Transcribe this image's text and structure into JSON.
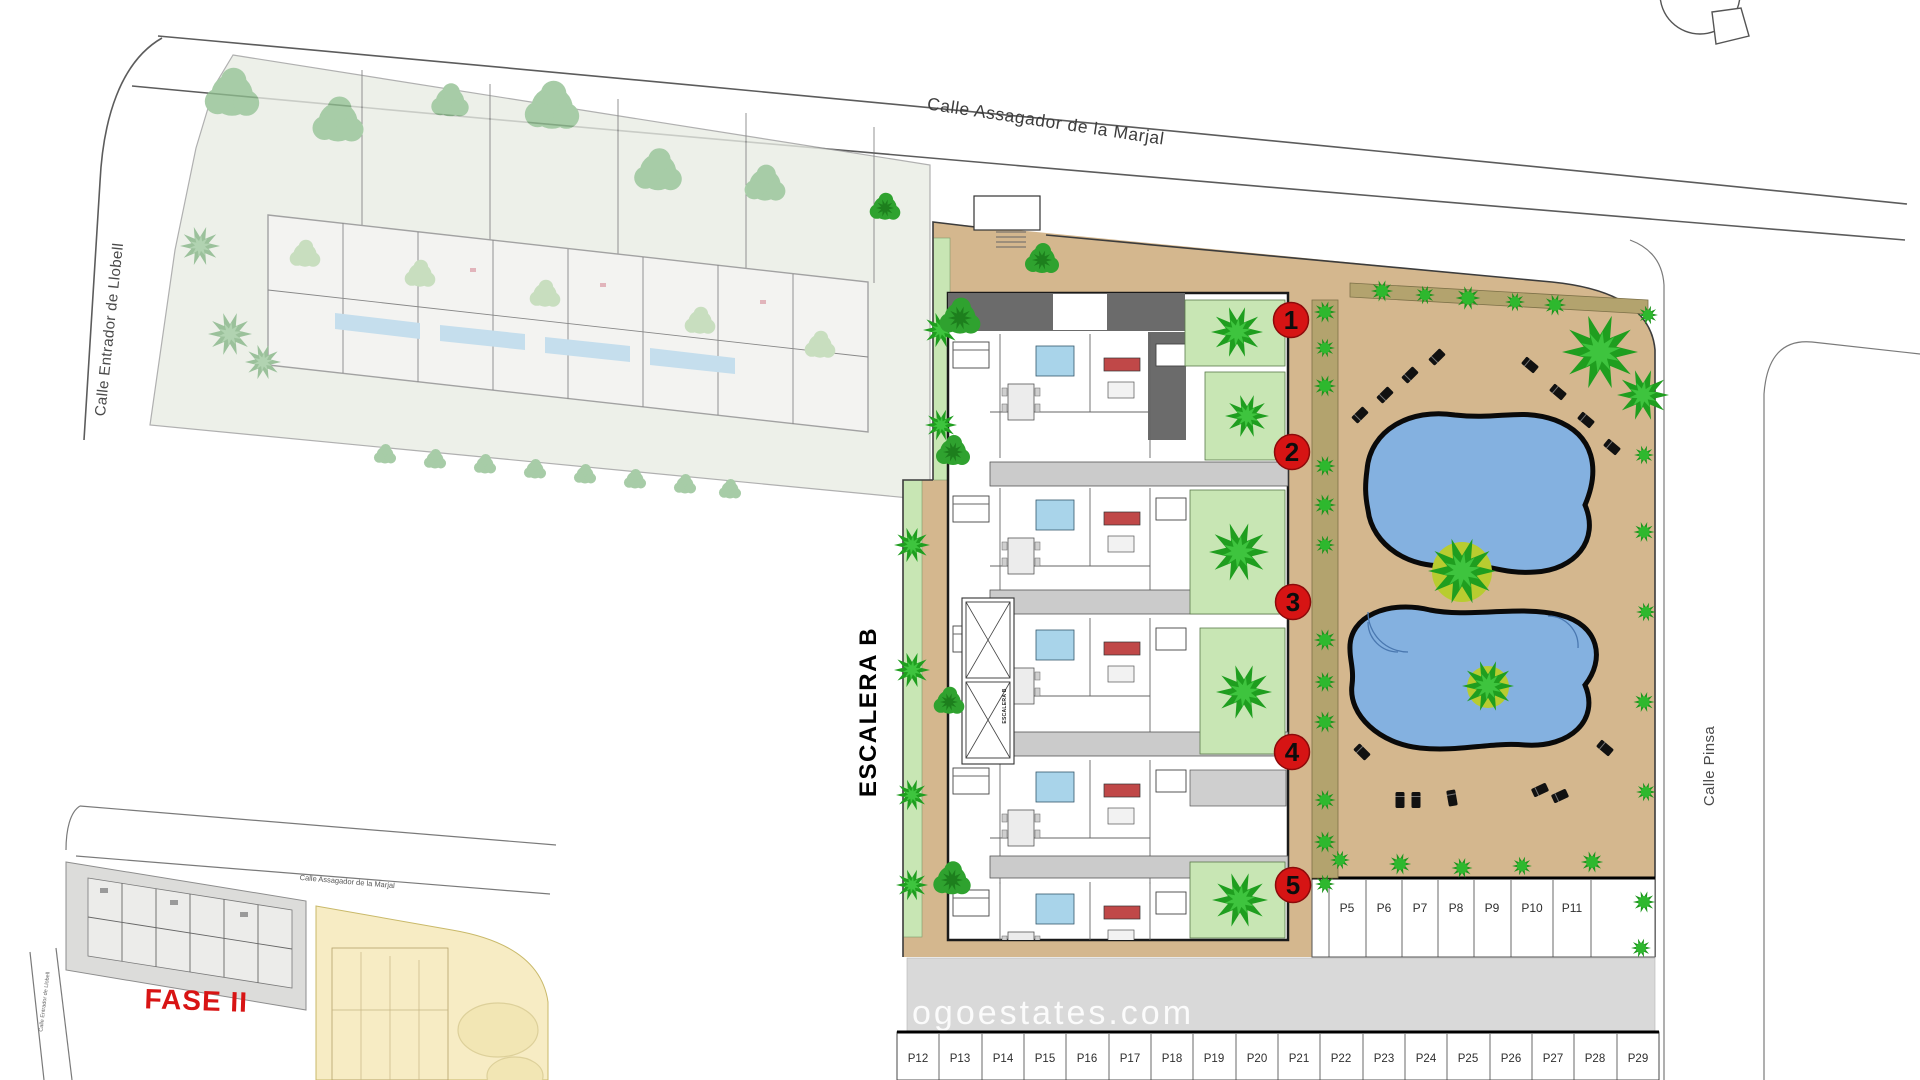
{
  "streets": {
    "top": "Calle Assagador de la Marjal",
    "left": "Calle Entrador de Llobell",
    "right": "Calle Pinsa"
  },
  "building": {
    "label": "ESCALERA B",
    "stair_label": "ESCALERA B"
  },
  "units": [
    "1",
    "2",
    "3",
    "4",
    "5"
  ],
  "parking": {
    "upper": [
      "P5",
      "P6",
      "P7",
      "P8",
      "P9",
      "P10",
      "P11"
    ],
    "lower": [
      "P12",
      "P13",
      "P14",
      "P15",
      "P16",
      "P17",
      "P18",
      "P19",
      "P20",
      "P21",
      "P22",
      "P23",
      "P24",
      "P25",
      "P26",
      "P27",
      "P28",
      "P29"
    ]
  },
  "inset": {
    "phase_label": "FASE II",
    "street_top": "Calle Assagador de la Marjal",
    "street_left": "Calle Entrador de Llobell"
  },
  "watermark": "ogoestates.com",
  "colors": {
    "ground_tan": "#d4b78e",
    "garden_green": "#c8e6b4",
    "tree_green": "#2eb82e",
    "tree_dark_green": "#1f9e1f",
    "pool_blue": "#84b1e0",
    "pool_outline": "#0a0a0a",
    "marker_red": "#d61414",
    "hedge_olive": "#b3a36e",
    "phase2_gray": "#e8ece4",
    "driveway_gray": "#d9d9d9",
    "roof_gray": "#6b6b6b",
    "bath_blue": "#a9d4ea",
    "sofa_red": "#c04848",
    "highlight_yellow": "#f7ecc4"
  }
}
